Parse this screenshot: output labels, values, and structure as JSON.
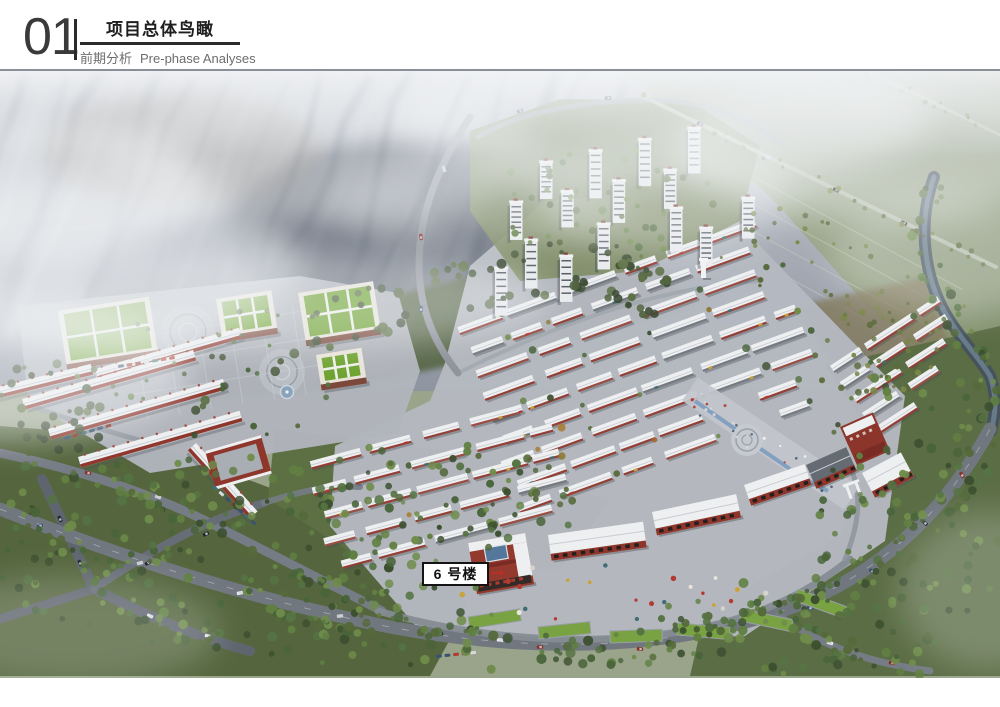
{
  "header": {
    "section_number": "01",
    "title": "项目总体鸟瞰",
    "subtitle_zh": "前期分析",
    "subtitle_en": "Pre-phase Analyses"
  },
  "annotation": {
    "building_label": "6 号楼"
  },
  "colors": {
    "header_text": "#3a3a3a",
    "header_subtext": "#6d6d6d",
    "header_rule": "#2b2b2b",
    "scene_frame": "#8a9097",
    "annotation_border": "#141414",
    "annotation_arrow": "#b43226",
    "mountain_grey": "#9aa1ab",
    "field_green": "#8a997b",
    "forest_green": "#5b6d45",
    "park_green": "#5c7043",
    "ground_grey": "#b5b9c0",
    "road_grey": "#71777f",
    "roof_white": "#edeff1",
    "accent_red": "#8f362c",
    "campus_roof_green": "#6da22e",
    "lawn_green": "#79a243",
    "water_blue": "#7e9cc0"
  }
}
